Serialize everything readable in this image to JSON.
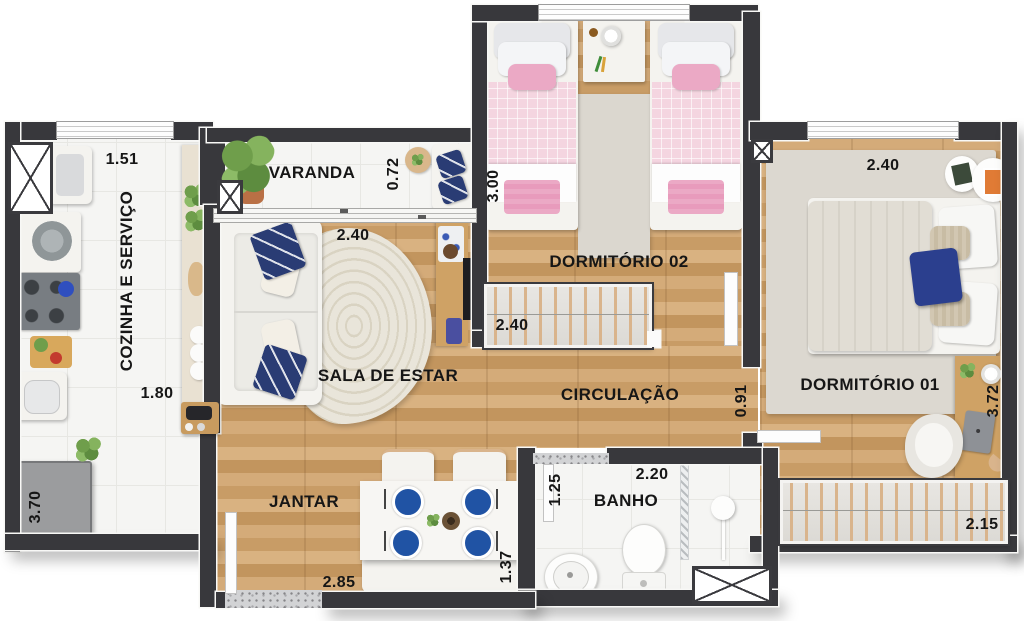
{
  "plan_title": "apartment-floor-plan",
  "rooms": {
    "cozinha": {
      "name": "COZINHA E SERVIÇO",
      "dim_top": "1.51",
      "dim_mid": "1.80",
      "dim_left": "3.70"
    },
    "varanda": {
      "name": "VARANDA",
      "dim_depth": "0.72"
    },
    "sala": {
      "name": "SALA DE ESTAR",
      "dim_width": "2.40"
    },
    "jantar": {
      "name": "JANTAR",
      "dim_width": "2.85",
      "dim_depth": "1.37"
    },
    "circulacao": {
      "name": "CIRCULAÇÃO",
      "dim_width": "0.91"
    },
    "dorm02": {
      "name": "DORMITÓRIO 02",
      "dim_height": "3.00",
      "dim_wardrobe": "2.40"
    },
    "dorm01": {
      "name": "DORMITÓRIO 01",
      "dim_width": "2.40",
      "dim_height": "3.72",
      "dim_wardrobe": "2.15"
    },
    "banho": {
      "name": "BANHO",
      "dim_width": "2.20",
      "dim_height": "1.25"
    }
  },
  "colors": {
    "wall": "#38383c",
    "wood_floor": "#cda36e",
    "tile_floor": "#f5f5f3",
    "accent_navy": "#2a3c74",
    "plate_blue": "#2053a4",
    "bed_pink": "#f4d5e0",
    "pink_accent": "#eba9c5",
    "hanger_tan": "#d9b48c",
    "rug_beige": "#dbd7cf"
  }
}
